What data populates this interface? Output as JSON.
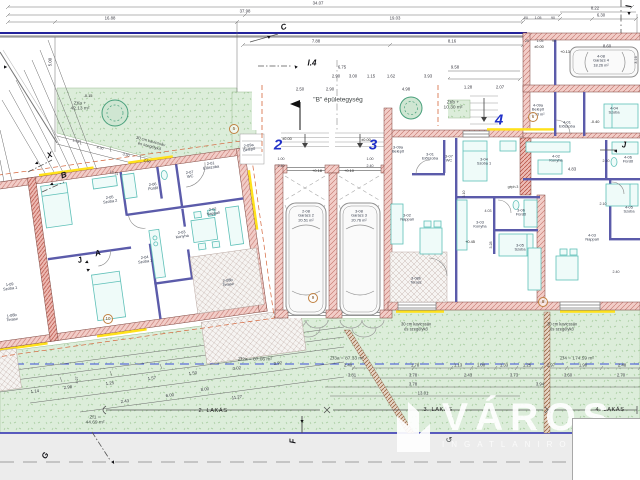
{
  "plan": {
    "building_label": "\"B\" épületegység",
    "watermark": {
      "brand": "VÁROS",
      "subtitle": "INGATLANIRODA"
    },
    "apartments": [
      {
        "t": "2",
        "x": 278,
        "y": 146
      },
      {
        "t": "3",
        "x": 373,
        "y": 146
      },
      {
        "t": "4",
        "x": 499,
        "y": 121
      }
    ],
    "unit_spans": [
      {
        "t": "2. LAKÁS",
        "x": 213,
        "y": 411
      },
      {
        "t": "3. LAKÁS",
        "x": 438,
        "y": 410
      },
      {
        "t": "4. LAKÁS",
        "x": 610,
        "y": 410
      }
    ],
    "rooms": [
      {
        "lines": [
          "1-09",
          "Szoba 1"
        ],
        "x": 10,
        "y": 287,
        "r": -8
      },
      {
        "lines": [
          "1-08b",
          "Terasz"
        ],
        "x": 12,
        "y": 318,
        "r": -8
      },
      {
        "lines": [
          "2-09a",
          "Belépő"
        ],
        "x": 249,
        "y": 148,
        "r": -8
      },
      {
        "lines": [
          "2-01",
          "Előszoba"
        ],
        "x": 211,
        "y": 166,
        "r": -8
      },
      {
        "lines": [
          "2-07",
          "WC"
        ],
        "x": 190,
        "y": 175,
        "r": -8
      },
      {
        "lines": [
          "2-06",
          "Fürdő"
        ],
        "x": 153,
        "y": 187,
        "r": -8
      },
      {
        "lines": [
          "2-05",
          "Szoba 2"
        ],
        "x": 110,
        "y": 200,
        "r": -8
      },
      {
        "lines": [
          "2-02",
          "Nappali"
        ],
        "x": 213,
        "y": 212,
        "r": -8
      },
      {
        "lines": [
          "2-03",
          "Konyha"
        ],
        "x": 182,
        "y": 235,
        "r": -8
      },
      {
        "lines": [
          "2-04",
          "Szoba 1"
        ],
        "x": 145,
        "y": 260,
        "r": -8
      },
      {
        "lines": [
          "2-08b",
          "Terasz"
        ],
        "x": 228,
        "y": 283,
        "r": -8
      },
      {
        "lines": [
          "2-08",
          "Garázs 2",
          "20.51 m²"
        ],
        "x": 306,
        "y": 216
      },
      {
        "lines": [
          "3-08",
          "Garázs 3",
          "20.76 m²"
        ],
        "x": 359,
        "y": 216
      },
      {
        "lines": [
          "3-09a",
          "Belépő"
        ],
        "x": 398,
        "y": 150
      },
      {
        "lines": [
          "3-01",
          "Előszoba"
        ],
        "x": 430,
        "y": 157
      },
      {
        "lines": [
          "3-07",
          "WC"
        ],
        "x": 449,
        "y": 159
      },
      {
        "lines": [
          "3-04",
          "Szoba 1"
        ],
        "x": 484,
        "y": 162
      },
      {
        "lines": [
          "3-02",
          "Nappali"
        ],
        "x": 407,
        "y": 218
      },
      {
        "lines": [
          "3-03",
          "Konyha"
        ],
        "x": 480,
        "y": 225
      },
      {
        "lines": [
          "3-06",
          "Fürdő"
        ],
        "x": 521,
        "y": 213
      },
      {
        "lines": [
          "3-05",
          "Szoba"
        ],
        "x": 520,
        "y": 248
      },
      {
        "lines": [
          "3-08b",
          "Terasz"
        ],
        "x": 416,
        "y": 281
      },
      {
        "lines": [
          "4-09a",
          "Belépő",
          "2.93 m²"
        ],
        "x": 538,
        "y": 110
      },
      {
        "lines": [
          "4-01",
          "Előszoba"
        ],
        "x": 567,
        "y": 125
      },
      {
        "lines": [
          "4-04",
          "Szoba"
        ],
        "x": 614,
        "y": 111
      },
      {
        "lines": [
          "4-02",
          "Konyha"
        ],
        "x": 556,
        "y": 159
      },
      {
        "lines": [
          "4-06",
          "Fürdő"
        ],
        "x": 628,
        "y": 160
      },
      {
        "lines": [
          "4-05",
          "Szoba"
        ],
        "x": 629,
        "y": 210
      },
      {
        "lines": [
          "4-03",
          "Nappali"
        ],
        "x": 592,
        "y": 238
      },
      {
        "lines": [
          "4-08",
          "Garázs 4",
          "18.26 m²"
        ],
        "x": 601,
        "y": 61
      }
    ],
    "areas": [
      {
        "lines": [
          "Zt/a +",
          "42.13 m²"
        ],
        "x": 80,
        "y": 107
      },
      {
        "lines": [
          "Zt/b +",
          "10.30 m²"
        ],
        "x": 453,
        "y": 106
      },
      {
        "t": "Zf2a = 87.06 m²",
        "x": 255,
        "y": 360
      },
      {
        "t": "Zf3a = 87.33 m²",
        "x": 347,
        "y": 359
      },
      {
        "t": "Zf4 = 174.59 m²",
        "x": 577,
        "y": 359
      },
      {
        "lines": [
          "Zf1 =",
          "44.69 m²"
        ],
        "x": 95,
        "y": 421
      }
    ],
    "dims": [
      {
        "t": "34.07",
        "x": 318,
        "y": 4
      },
      {
        "t": "37.98",
        "x": 245,
        "y": 12
      },
      {
        "t": "16.88",
        "x": 110,
        "y": 19
      },
      {
        "t": "19.03",
        "x": 395,
        "y": 19
      },
      {
        "t": "8.22",
        "x": 595,
        "y": 9
      },
      {
        "t": "6.30",
        "x": 601,
        "y": 16
      },
      {
        "t": "20",
        "x": 526,
        "y": 19,
        "s": 3.5
      },
      {
        "t": "1.05",
        "x": 538,
        "y": 19,
        "s": 3.5
      },
      {
        "t": "90",
        "x": 553,
        "y": 19,
        "s": 3.5
      },
      {
        "t": "7.88",
        "x": 316,
        "y": 42
      },
      {
        "t": "8.16",
        "x": 452,
        "y": 42
      },
      {
        "t": "25",
        "x": 527,
        "y": 42,
        "s": 3.5
      },
      {
        "t": "1.05",
        "x": 540,
        "y": 42,
        "s": 3.5
      },
      {
        "t": "90",
        "x": 554,
        "y": 42,
        "s": 3.5
      },
      {
        "t": "8.60",
        "x": 607,
        "y": 47
      },
      {
        "t": "6.75",
        "x": 342,
        "y": 68
      },
      {
        "t": "9.58",
        "x": 455,
        "y": 68
      },
      {
        "t": "3.16",
        "x": 636,
        "y": 60,
        "r": -90,
        "s": 3.8
      },
      {
        "t": "2.90",
        "x": 336,
        "y": 77
      },
      {
        "t": "3.00",
        "x": 353,
        "y": 77
      },
      {
        "t": "1.15",
        "x": 371,
        "y": 77
      },
      {
        "t": "1.62",
        "x": 391,
        "y": 77
      },
      {
        "t": "3.93",
        "x": 428,
        "y": 77
      },
      {
        "t": "2.50",
        "x": 300,
        "y": 90
      },
      {
        "t": "2.90",
        "x": 330,
        "y": 90
      },
      {
        "t": "4.98",
        "x": 406,
        "y": 90
      },
      {
        "t": "1.28",
        "x": 468,
        "y": 88
      },
      {
        "t": "2.07",
        "x": 500,
        "y": 88
      },
      {
        "t": "1.00",
        "x": 281,
        "y": 159,
        "s": 3.6
      },
      {
        "t": "2.40",
        "x": 281,
        "y": 166,
        "s": 3.6
      },
      {
        "t": "1.00",
        "x": 370,
        "y": 159,
        "s": 3.6
      },
      {
        "t": "2.40",
        "x": 370,
        "y": 166,
        "s": 3.6
      },
      {
        "t": "5.00",
        "x": 51,
        "y": 62,
        "r": -90
      },
      {
        "t": "4.83",
        "x": 572,
        "y": 170
      },
      {
        "t": "2.10",
        "x": 606,
        "y": 161,
        "s": 3.6
      },
      {
        "t": "2.10",
        "x": 603,
        "y": 204,
        "s": 3.6
      },
      {
        "t": "3.28",
        "x": 491,
        "y": 245,
        "r": -90,
        "s": 3.6
      },
      {
        "t": "3.10",
        "x": 464,
        "y": 194,
        "r": -90,
        "s": 3.6
      },
      {
        "t": "2.40",
        "x": 616,
        "y": 272,
        "s": 3.6
      },
      {
        "t": "4.03",
        "x": 488,
        "y": 211,
        "s": 3.6
      },
      {
        "t": "1.25",
        "x": 76,
        "y": 141,
        "r": 15,
        "s": 3.6
      },
      {
        "t": "4.30",
        "x": 100,
        "y": 148,
        "r": 15,
        "s": 3.6
      },
      {
        "t": "3.30",
        "x": 126,
        "y": 155,
        "r": 15,
        "s": 3.6
      },
      {
        "t": "2.50",
        "x": 147,
        "y": 161,
        "r": 15,
        "s": 3.6
      },
      {
        "t": "12.31",
        "x": 114,
        "y": 173,
        "r": 15,
        "s": 3.6
      },
      {
        "t": "1.14",
        "x": 35,
        "y": 392,
        "r": -8
      },
      {
        "t": "2.98",
        "x": 68,
        "y": 388,
        "r": -8
      },
      {
        "t": "1.25",
        "x": 110,
        "y": 384,
        "r": -8
      },
      {
        "t": "1.57",
        "x": 152,
        "y": 379,
        "r": -8
      },
      {
        "t": "1.50",
        "x": 193,
        "y": 374,
        "r": -8
      },
      {
        "t": "3.02",
        "x": 237,
        "y": 369,
        "r": -8
      },
      {
        "t": "3.92",
        "x": 278,
        "y": 364,
        "r": -8
      },
      {
        "t": "8.00",
        "x": 205,
        "y": 390,
        "r": -8
      },
      {
        "t": "11.27",
        "x": 237,
        "y": 398,
        "r": -8
      },
      {
        "t": "2.43",
        "x": 125,
        "y": 402,
        "r": -8
      },
      {
        "t": "6.00",
        "x": 170,
        "y": 396,
        "r": -8
      },
      {
        "t": "4.27",
        "x": 77,
        "y": 380,
        "r": -90,
        "s": 3.6
      },
      {
        "t": "2.40",
        "x": 348,
        "y": 366
      },
      {
        "t": "1.78",
        "x": 415,
        "y": 366
      },
      {
        "t": "1.13",
        "x": 458,
        "y": 366
      },
      {
        "t": "1.00",
        "x": 481,
        "y": 366
      },
      {
        "t": "1.33",
        "x": 504,
        "y": 366
      },
      {
        "t": "1.25",
        "x": 527,
        "y": 366
      },
      {
        "t": "2.97",
        "x": 551,
        "y": 366
      },
      {
        "t": "1.90",
        "x": 583,
        "y": 366
      },
      {
        "t": "2.48",
        "x": 622,
        "y": 366
      },
      {
        "t": "3.81",
        "x": 352,
        "y": 376
      },
      {
        "t": "3.78",
        "x": 413,
        "y": 376
      },
      {
        "t": "2.43",
        "x": 468,
        "y": 376
      },
      {
        "t": "3.73",
        "x": 514,
        "y": 376
      },
      {
        "t": "3.60",
        "x": 568,
        "y": 376
      },
      {
        "t": "2.70",
        "x": 621,
        "y": 376
      },
      {
        "t": "3.78",
        "x": 413,
        "y": 385
      },
      {
        "t": "3.94",
        "x": 540,
        "y": 385
      },
      {
        "t": "13.01",
        "x": 423,
        "y": 394
      }
    ],
    "levels": [
      {
        "t": "±0.00",
        "x": 287,
        "y": 139
      },
      {
        "t": "±0.00",
        "x": 366,
        "y": 140
      },
      {
        "t": "±0.00",
        "x": 539,
        "y": 47
      },
      {
        "t": "+0.13",
        "x": 565,
        "y": 52
      },
      {
        "t": "-0.40",
        "x": 595,
        "y": 122
      },
      {
        "t": "-0.15",
        "x": 88,
        "y": 96
      },
      {
        "t": "+0.45",
        "x": 470,
        "y": 242
      },
      {
        "t": "+0.18",
        "x": 317,
        "y": 171
      },
      {
        "t": "+0.10",
        "x": 349,
        "y": 171
      }
    ],
    "markers": [
      {
        "t": "C",
        "x": 284,
        "y": 28,
        "r": -20
      },
      {
        "t": "I.4",
        "x": 312,
        "y": 64
      },
      {
        "t": "I",
        "x": 627,
        "y": 6,
        "r": 90
      },
      {
        "t": "X",
        "x": 50,
        "y": 156,
        "r": -18
      },
      {
        "t": "B",
        "x": 64,
        "y": 176,
        "r": -18
      },
      {
        "t": "A",
        "x": 98,
        "y": 254,
        "r": -18
      },
      {
        "t": "J",
        "x": 80,
        "y": 261,
        "r": -18
      },
      {
        "t": "J",
        "x": 624,
        "y": 146
      },
      {
        "t": "F",
        "x": 294,
        "y": 441,
        "r": -90
      },
      {
        "t": "G",
        "x": 46,
        "y": 456,
        "r": -60
      }
    ],
    "marker_arrows": [
      {
        "t": "▲",
        "x": 296,
        "y": 67,
        "r": -40
      },
      {
        "t": "▲",
        "x": 269,
        "y": 37,
        "r": -60
      },
      {
        "t": "▲",
        "x": 37,
        "y": 163,
        "r": -115
      },
      {
        "t": "▲",
        "x": 52,
        "y": 184,
        "r": -115
      },
      {
        "t": "▲",
        "x": 87,
        "y": 262,
        "r": -115
      },
      {
        "t": "▲",
        "x": 88,
        "y": 270,
        "r": 65
      },
      {
        "t": "▲",
        "x": 616,
        "y": 151,
        "r": -90
      },
      {
        "t": "▲",
        "x": 302,
        "y": 421,
        "r": 180
      },
      {
        "t": "▲",
        "x": 113,
        "y": 462,
        "r": 150
      },
      {
        "t": "▲",
        "x": 629,
        "y": 13,
        "r": 180
      },
      {
        "t": "▲",
        "x": 5,
        "y": 67,
        "r": 90
      }
    ],
    "detail_circles": [
      {
        "t": "5",
        "x": 234,
        "y": 129
      },
      {
        "t": "6",
        "x": 533,
        "y": 117
      },
      {
        "t": "8",
        "x": 543,
        "y": 302
      },
      {
        "t": "9",
        "x": 313,
        "y": 298
      },
      {
        "t": "10",
        "x": 108,
        "y": 319
      }
    ],
    "notes": [
      {
        "t": "\"B\" épületegység",
        "x": 338,
        "y": 100,
        "s": 6.5
      },
      {
        "lines": [
          "30 cm kavicssáv",
          "és szegélykő"
        ],
        "x": 416,
        "y": 327
      },
      {
        "lines": [
          "30 cm kavicssáv",
          "és szegélykő"
        ],
        "x": 562,
        "y": 327
      },
      {
        "lines": [
          "30 cm kavicssáv",
          "és szegélykő"
        ],
        "x": 150,
        "y": 144,
        "r": 15
      },
      {
        "t": "géph.3",
        "x": 513,
        "y": 188,
        "s": 3.5
      },
      {
        "t": "↺",
        "x": 449,
        "y": 441,
        "s": 8
      }
    ],
    "colors": {
      "boundary_line": "#24249c",
      "wall_fill": "#f2cdc8",
      "wall_hatch": "#c4736a",
      "insulation_yellow": "#ffe11a",
      "partition_blue": "#5b5baa",
      "apartment_number_blue": "#2030c8",
      "lawn_green": "#dcedda",
      "furniture_teal": "#5ec0b8",
      "setback_dashed_blue": "#3b4fd8",
      "overhang_dashed_red": "#d4663c"
    }
  }
}
